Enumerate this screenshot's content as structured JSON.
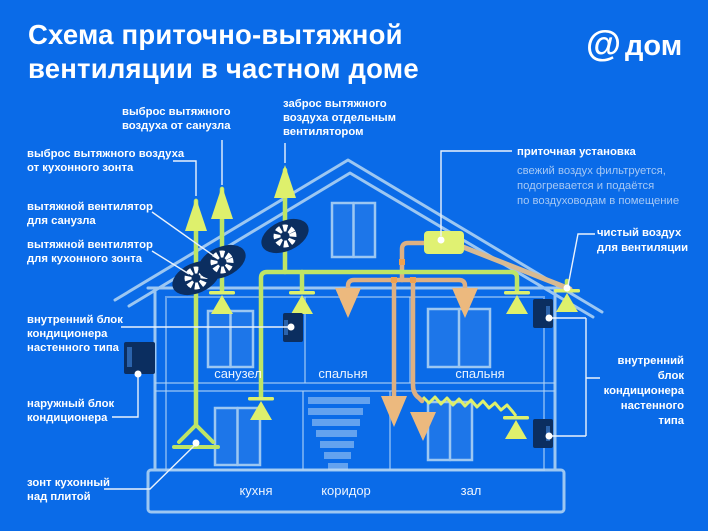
{
  "page": {
    "title_lines": [
      "Схема приточно-вытяжной",
      "вентиляции в частном доме"
    ],
    "logo_at": "@",
    "logo_word": "дом"
  },
  "colors": {
    "bg": "#0A6BE8",
    "house_line": "#9CC7F2",
    "house_line_soft": "rgba(176,211,245,0.55)",
    "window_fill": "rgba(255,255,255,0.08)",
    "stair_fill": "rgba(188,217,246,0.5)",
    "duct_green": "#BEE566",
    "valve_green": "#DEF06C",
    "duct_orange": "#DDB083",
    "diffuser_orange": "#ECB97E",
    "junction_orange": "#F0A14E",
    "duct_tan": "#D8BA92",
    "navy": "#0B2E60",
    "navy_light": "#2B63AC",
    "unit_green": "#E0F172",
    "connector": "#EAF2FC",
    "text_white": "#FFFFFF",
    "text_soft": "#A6C8F4",
    "room_text": "rgba(255,255,255,0.92)"
  },
  "labels": {
    "exhaust_san": {
      "lines": [
        "выброс вытяжного",
        "воздуха от санузла"
      ]
    },
    "exhaust_separate": {
      "lines": [
        "заброс вытяжного",
        "воздуха отдельным",
        "вентилятором"
      ]
    },
    "exhaust_hood": {
      "lines": [
        "выброс вытяжного воздуха",
        "от кухонного зонта"
      ]
    },
    "fan_san": {
      "lines": [
        "вытяжной вентилятор",
        "для санузла"
      ]
    },
    "fan_hood": {
      "lines": [
        "вытяжной вентилятор",
        "для кухонного зонта"
      ]
    },
    "indoor_left": {
      "lines": [
        "внутренний блок",
        "кондиционера",
        "настенного типа"
      ]
    },
    "outdoor": {
      "lines": [
        "наружный блок",
        "кондиционера"
      ]
    },
    "hood": {
      "lines": [
        "зонт кухонный",
        "над плитой"
      ]
    },
    "supply_unit": {
      "title": "приточная установка",
      "desc_lines": [
        "свежий воздух фильтруется,",
        "подогревается и подаётся",
        "по воздуховодам в помещение"
      ]
    },
    "clean_air": {
      "lines": [
        "чистый воздух",
        "для вентиляции"
      ]
    },
    "indoor_right": {
      "lines": [
        "внутренний",
        "блок",
        "кондиционера",
        "настенного",
        "типа"
      ]
    }
  },
  "rooms": {
    "floor2": [
      "санузел",
      "спальня",
      "спальня"
    ],
    "floor1": [
      "кухня",
      "коридор",
      "зал"
    ]
  }
}
